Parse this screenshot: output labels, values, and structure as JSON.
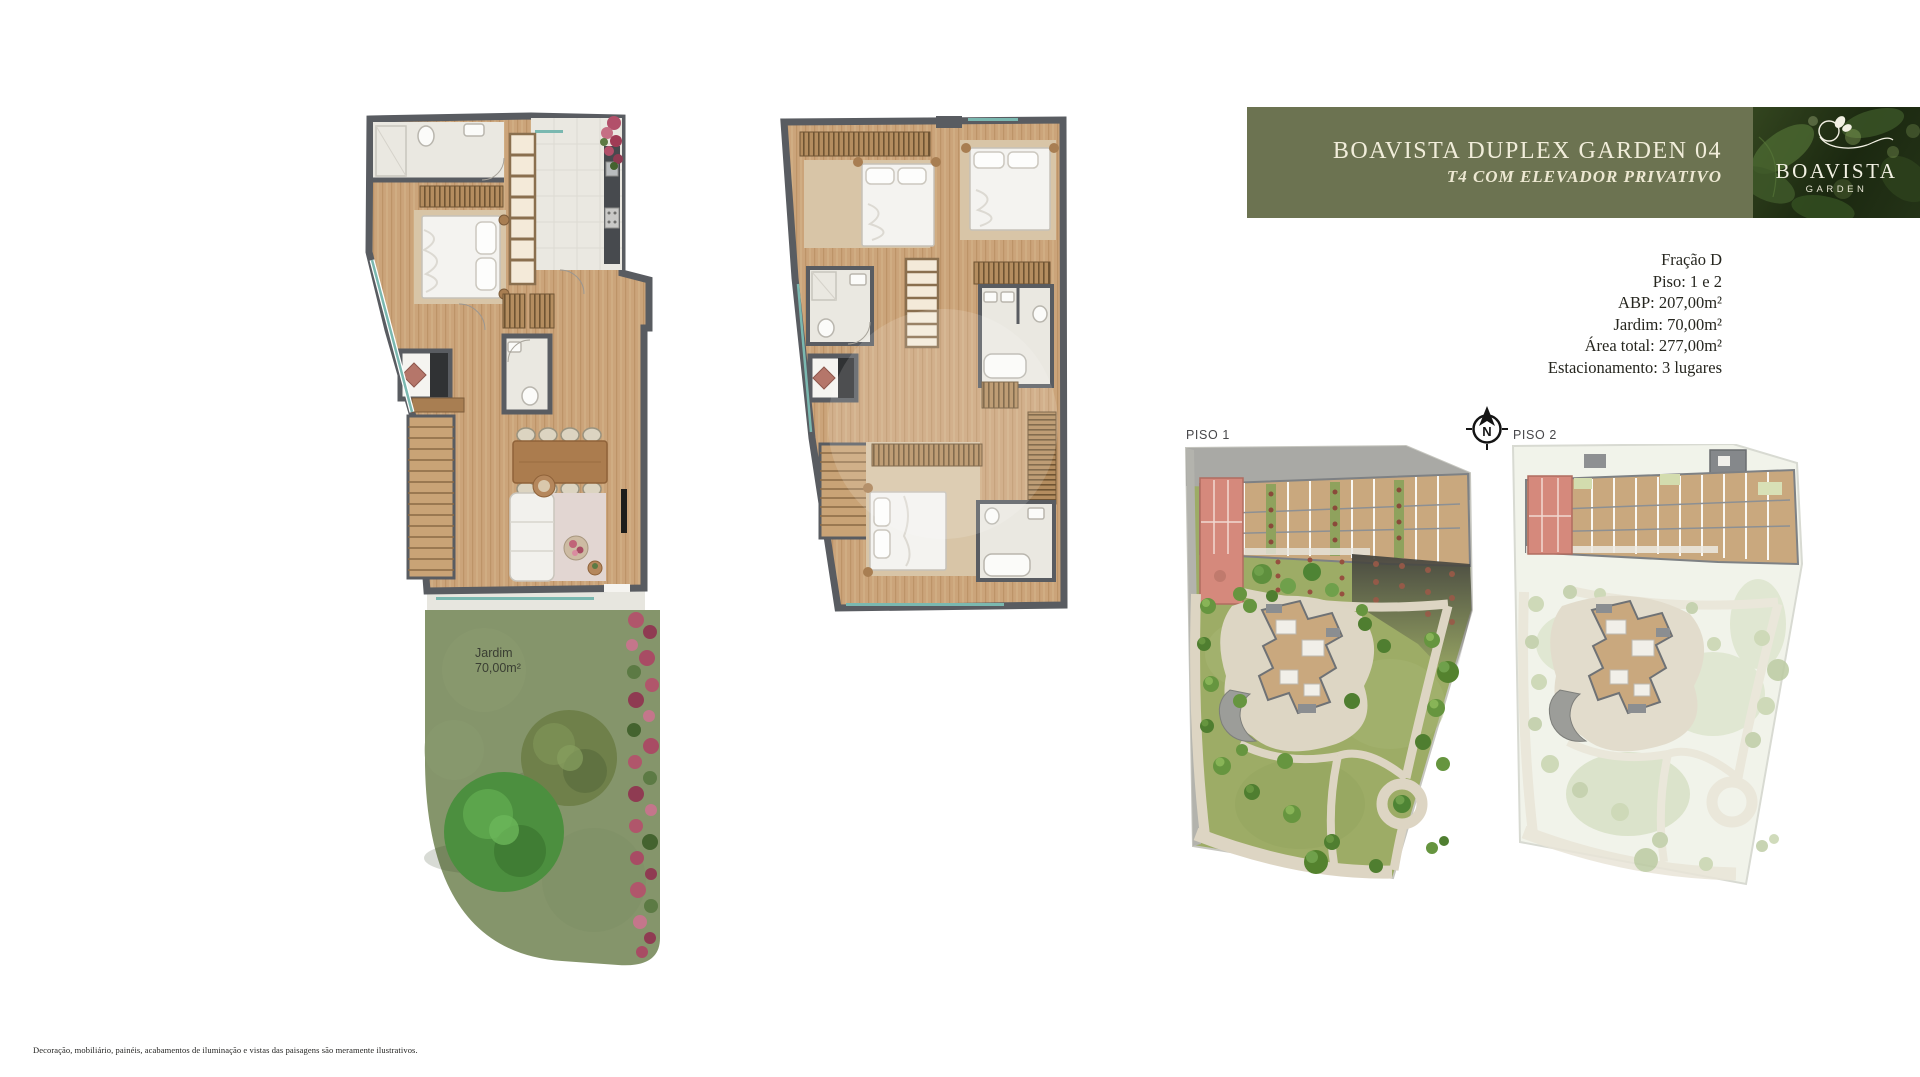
{
  "colors": {
    "banner_bg": "#6C7351",
    "banner_text": "#F1EDDA",
    "highlighted_unit": "#D5897C",
    "garden_green": "#85956B",
    "siteplan_green": "#9DAC66"
  },
  "header": {
    "title": "BOAVISTA DUPLEX GARDEN 04",
    "subtitle": "T4 COM ELEVADOR PRIVATIVO"
  },
  "logo": {
    "wordmark": "BOAVISTA",
    "tagline": "GARDEN"
  },
  "unit_details": {
    "lines": [
      "Fração D",
      "Piso: 1 e 2",
      "ABP: 207,00m²",
      "Jardim: 70,00m²",
      "Área total: 277,00m²",
      "Estacionamento: 3 lugares"
    ]
  },
  "floorplans": {
    "garden_label": "Jardim",
    "garden_area": "70,00m²"
  },
  "siteplans": {
    "piso1_label": "PISO 1",
    "piso2_label": "PISO 2",
    "compass_letter": "N"
  },
  "footer": {
    "disclaimer": "Decoração, mobiliário, painéis, acabamentos de iluminação e vistas das paisagens são meramente ilustrativos."
  }
}
